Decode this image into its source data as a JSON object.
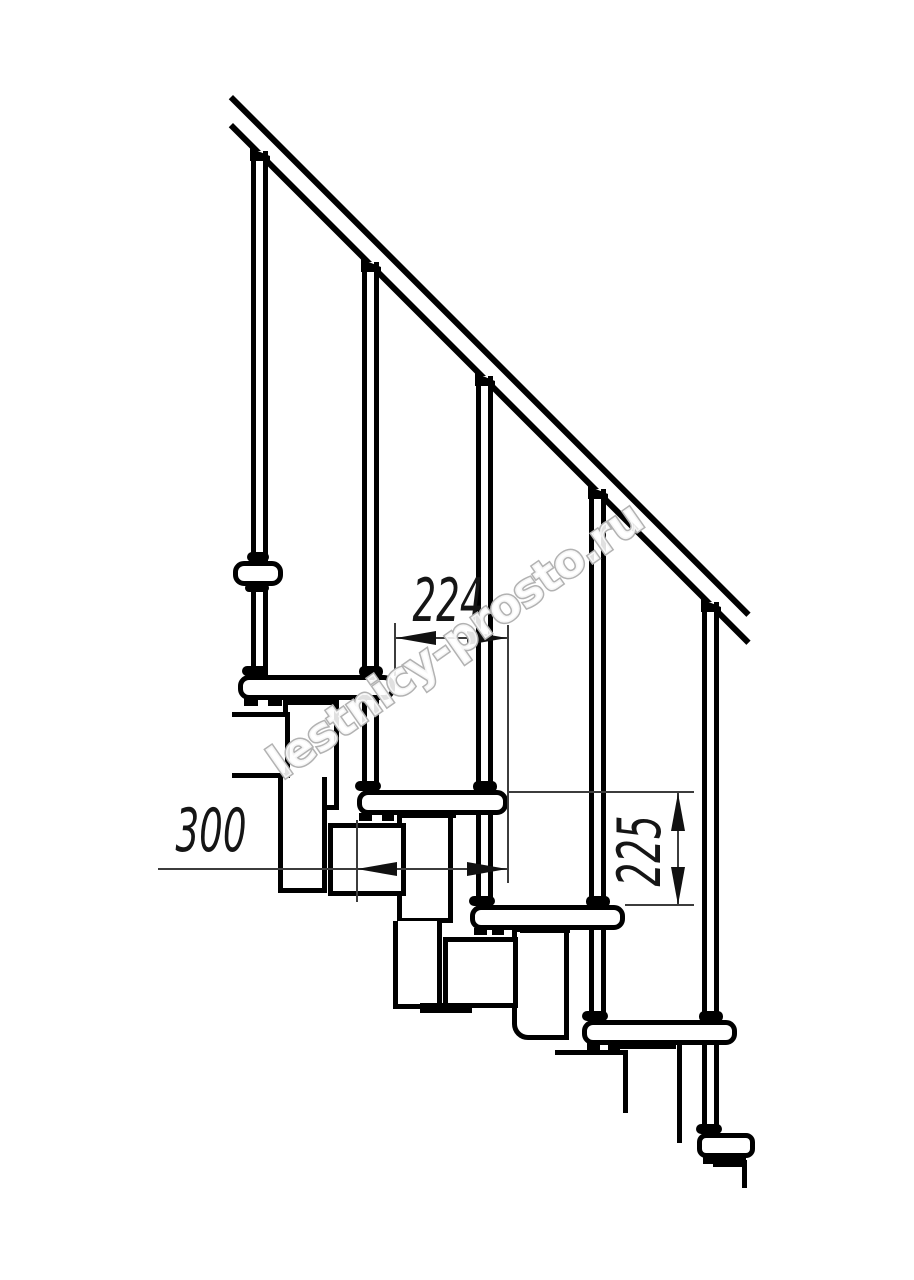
{
  "watermark": {
    "text": "lestnicy-prosto.ru"
  },
  "dimensions": {
    "dim_horizontal_small": "224",
    "dim_horizontal_large": "300",
    "dim_vertical": "225"
  },
  "colors": {
    "drawing_line": "#000000",
    "dimension_line": "#3c3c3c",
    "watermark_outline": "#b2b2b2",
    "background": "#ffffff"
  }
}
